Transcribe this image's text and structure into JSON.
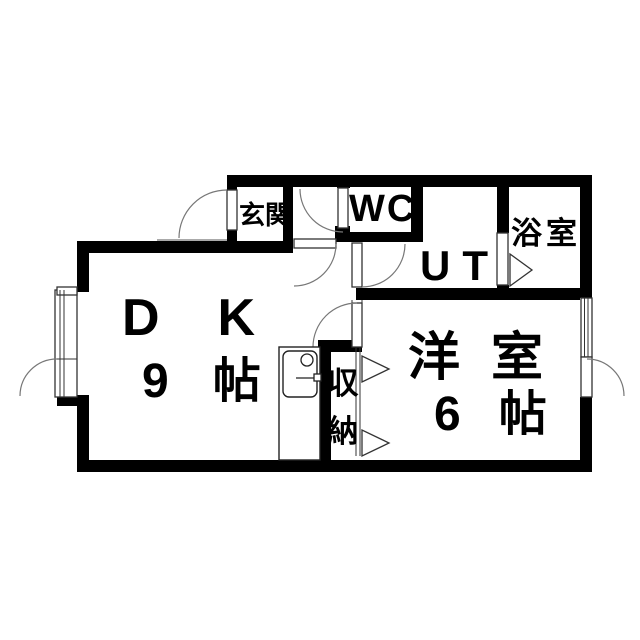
{
  "floorplan": {
    "title": "apartment-floor-plan",
    "rooms": {
      "genkan": {
        "label": "玄関"
      },
      "wc": {
        "label": "WC"
      },
      "ut": {
        "label": "UT"
      },
      "bath": {
        "label": "浴室"
      },
      "dk": {
        "label": "DK",
        "size": "9帖"
      },
      "western_room": {
        "label": "洋室",
        "size": "6帖"
      },
      "closet": {
        "label": "収納",
        "chars": [
          "収",
          "納"
        ]
      }
    },
    "colors": {
      "wall": "#000000",
      "background": "#ffffff",
      "frame_line": "#333333",
      "arc_line": "#777777"
    }
  }
}
